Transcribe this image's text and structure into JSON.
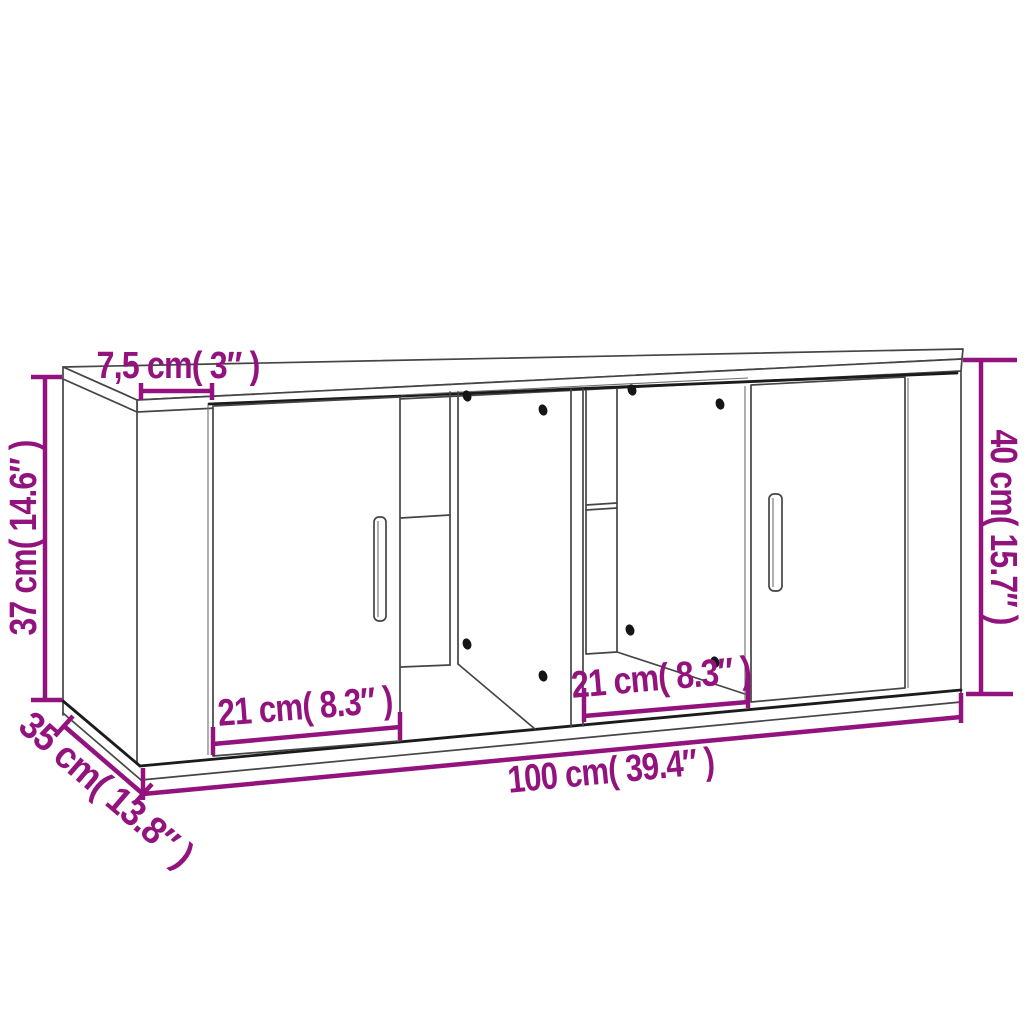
{
  "diagram": {
    "kind": "product-dimension-diagram",
    "subject": "tv-cabinet-with-2-doors-and-open-compartments",
    "colors": {
      "dimension_accent": "#93137E",
      "line": "#454545",
      "line_dark": "#1B1B1B",
      "background": "#FFFFFF",
      "screw_hole": "#151515"
    },
    "dimensions": {
      "top_depth": "7,5 cm( 3″ )",
      "left_height": "37 cm( 14.6″ )",
      "right_height": "40 cm( 15.7″ )",
      "side_depth": "35 cm( 13.8″ )",
      "width": "100 cm( 39.4″ )",
      "left_compartment_width": "21 cm( 8.3″ )",
      "right_compartment_width": "21 cm( 8.3″ )"
    }
  }
}
